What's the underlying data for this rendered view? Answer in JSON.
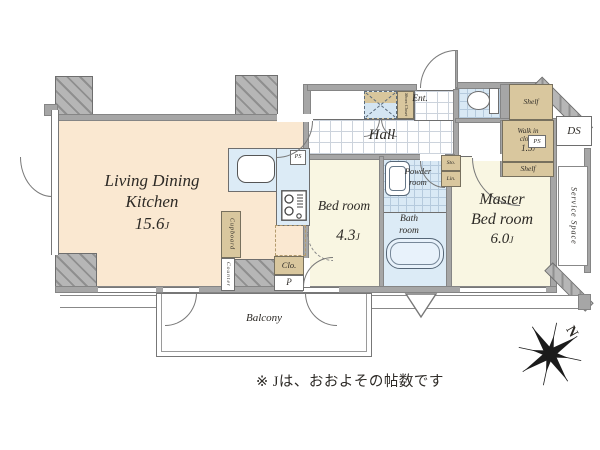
{
  "colors": {
    "floor_ldk": "#FAE8D1",
    "floor_bedroom": "#F9F6E2",
    "floor_wet": "#DCEBF6",
    "cabinet_tan": "#D9C79E",
    "wall_gray": "#A6A6A6",
    "line_gray": "#6E6E6E",
    "text": "#2D2A26"
  },
  "rooms": {
    "ldk": {
      "line1": "Living Dining",
      "line2": "Kitchen",
      "size": "15.6",
      "unit": "J"
    },
    "bedroom": {
      "label": "Bed room",
      "size": "4.3",
      "unit": "J"
    },
    "master": {
      "line1": "Master",
      "line2": "Bed room",
      "size": "6.0",
      "unit": "J"
    },
    "hall": {
      "label": "Hall"
    },
    "entrance": {
      "label": "Ent."
    },
    "powder": {
      "line1": "Powder",
      "line2": "room"
    },
    "bathroom": {
      "line1": "Bath",
      "line2": "room"
    },
    "balcony": {
      "label": "Balcony"
    },
    "walk_in_closet": {
      "line1": "Walk in",
      "line2": "closet",
      "size": "1.5",
      "unit": "J"
    },
    "service_space": {
      "label": "Service Space"
    },
    "ds": {
      "label": "DS"
    }
  },
  "fixtures": {
    "shelf_top": "Shelf",
    "shelf_bottom": "Shelf",
    "shoes_closet": "Shoes Closet",
    "cupboard": "Cupboard",
    "counter": "Counter",
    "closet": "Clo.",
    "pipe": "P",
    "storage": "Sto.",
    "linen": "Lin.",
    "ps_kitchen": "PS",
    "ps_closet": "PS"
  },
  "annotations": {
    "note": "※ Jは、おおよその帖数です",
    "compass_north": "N"
  }
}
